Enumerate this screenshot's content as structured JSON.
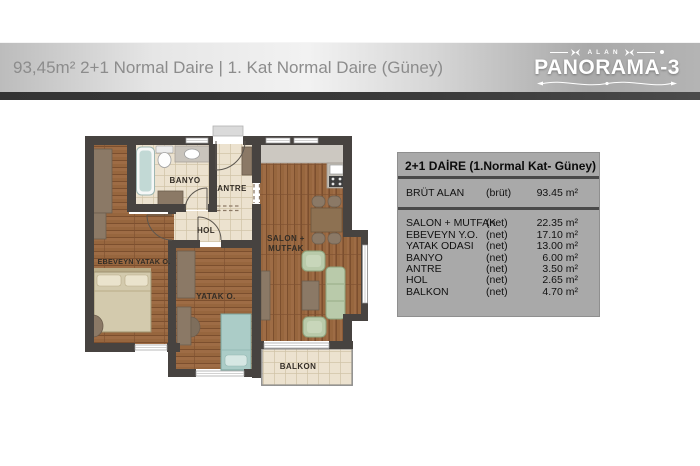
{
  "header": {
    "title": "93,45m² 2+1 Normal Daire | 1. Kat Normal Daire (Güney)",
    "logo": {
      "brand_top": "ALAN",
      "brand": "PANORAMA-3"
    }
  },
  "info_table": {
    "title": "2+1 DAİRE (1.Normal Kat- Güney)",
    "gross": {
      "name": "BRÜT ALAN",
      "basis": "(brüt)",
      "value": "93.45 m²"
    },
    "rows": [
      {
        "name": "SALON + MUTFAK",
        "basis": "(net)",
        "value": "22.35 m²"
      },
      {
        "name": "EBEVEYN Y.O.",
        "basis": "(net)",
        "value": "17.10 m²"
      },
      {
        "name": "YATAK ODASI",
        "basis": "(net)",
        "value": "13.00 m²"
      },
      {
        "name": "BANYO",
        "basis": "(net)",
        "value": "6.00 m²"
      },
      {
        "name": "ANTRE",
        "basis": "(net)",
        "value": "3.50 m²"
      },
      {
        "name": "HOL",
        "basis": "(net)",
        "value": "2.65 m²"
      },
      {
        "name": "BALKON",
        "basis": "(net)",
        "value": "4.70 m²"
      }
    ]
  },
  "floor_plan": {
    "labels": {
      "banyo": "BANYO",
      "antre": "ANTRE",
      "hol": "HOL",
      "salon_line1": "SALON +",
      "salon_line2": "MUTFAK",
      "ebeveyn": "EBEVEYN YATAK O.",
      "yatak": "YATAK O.",
      "balkon": "BALKON"
    }
  },
  "colors": {
    "wall": "#474340",
    "wood_floor": "#97663e",
    "tile_floor": "#ece2cf",
    "furniture": "#8b7966",
    "sofa_green": "#b9caaa",
    "table_background": "#a9a9a9",
    "header_text": "#8c8c8c",
    "logo_text": "#ffffff"
  }
}
